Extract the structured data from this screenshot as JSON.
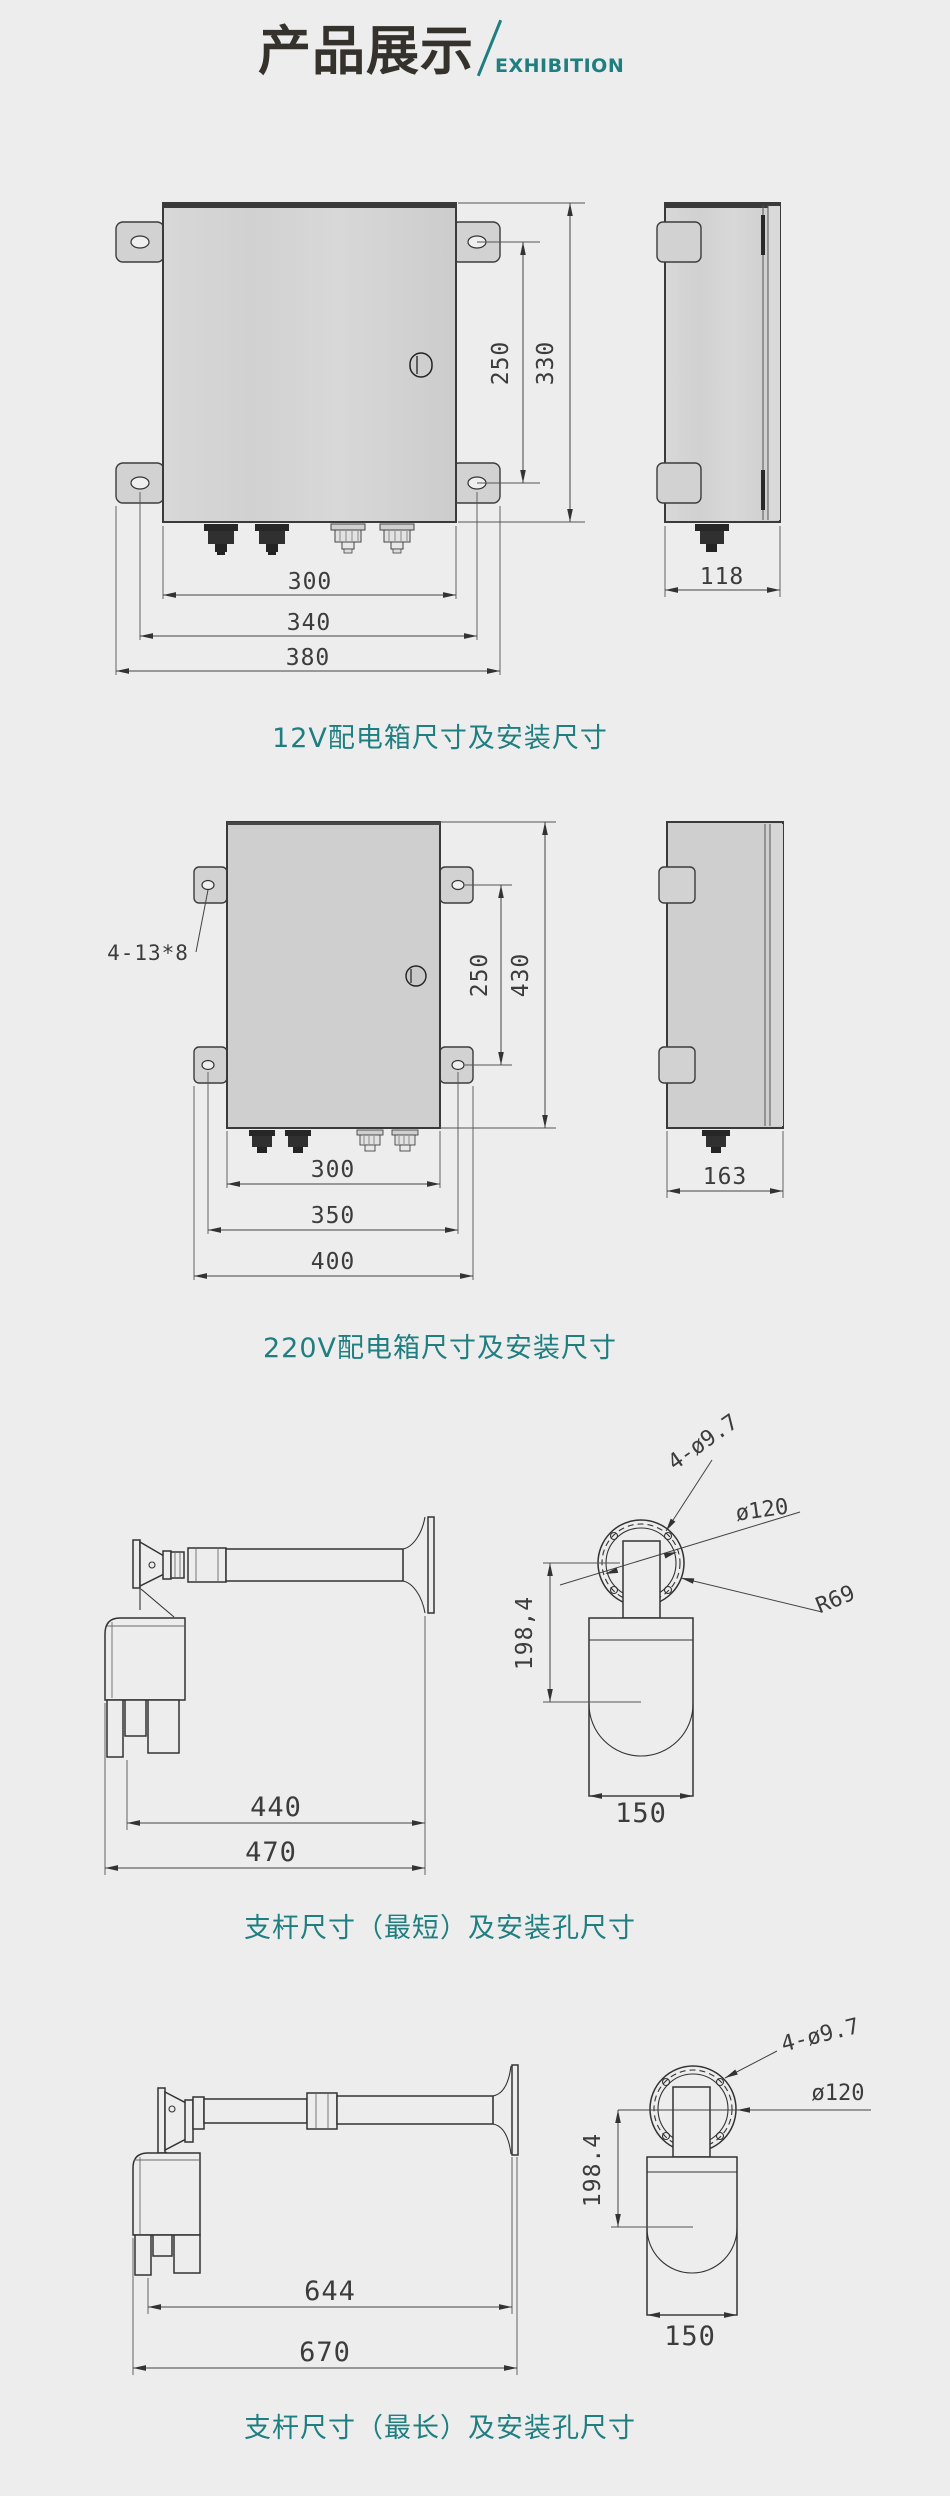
{
  "header": {
    "title": "产品展示",
    "divider": "/",
    "subtitle": "EXHIBITION"
  },
  "theme": {
    "accent_teal": "#1F7E80",
    "line_color": "#333333",
    "box_fill": "#D2D2D2",
    "background": "#EDEDED"
  },
  "sections": {
    "box12v": {
      "caption": "12V配电箱尺寸及安装尺寸",
      "dims": {
        "v250": "250",
        "v330": "330",
        "v300": "300",
        "v340": "340",
        "v380": "380",
        "v118": "118"
      }
    },
    "box220v": {
      "caption": "220V配电箱尺寸及安装尺寸",
      "mount_hole_label": "4-13*8",
      "dims": {
        "v250": "250",
        "v430": "430",
        "v300": "300",
        "v350": "350",
        "v400": "400",
        "v163": "163"
      }
    },
    "pole_short": {
      "caption": "支杆尺寸（最短）及安装孔尺寸",
      "dims": {
        "v440": "440",
        "v470": "470",
        "v150": "150",
        "v198": "198,4",
        "holes": "4-ø9.7",
        "dia": "ø120",
        "radius": "R69"
      }
    },
    "pole_long": {
      "caption": "支杆尺寸（最长）及安装孔尺寸",
      "dims": {
        "v644": "644",
        "v670": "670",
        "v150": "150",
        "v198": "198.4",
        "holes": "4-ø9.7",
        "dia": "ø120"
      }
    }
  }
}
